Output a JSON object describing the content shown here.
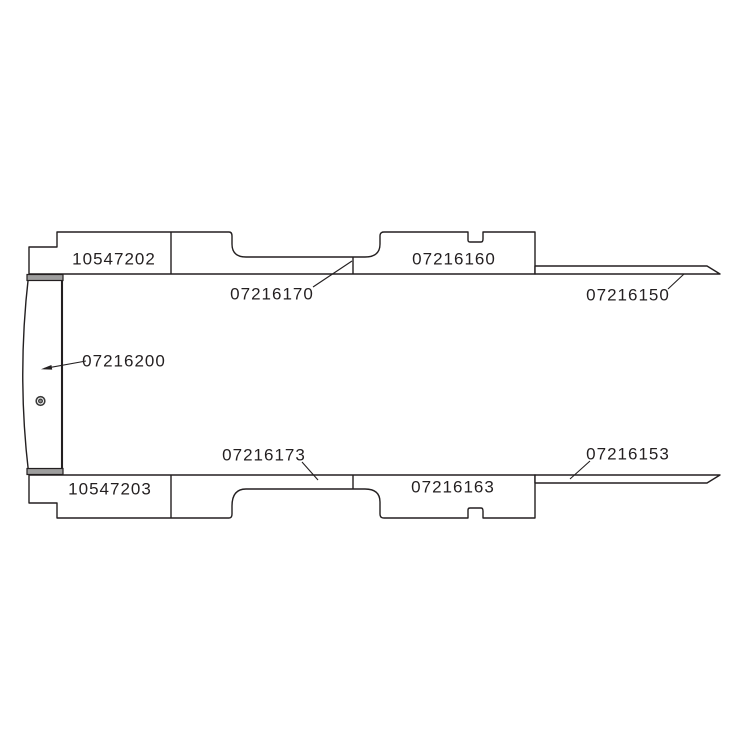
{
  "diagram": {
    "kind": "vehicle panel parts line drawing",
    "colors": {
      "background": "#ffffff",
      "line": "#231f20",
      "seal_band": "#9e9e9e"
    }
  },
  "parts": [
    {
      "number": "10547202",
      "area": "top rail left panel"
    },
    {
      "number": "07216170",
      "area": "top rail recessed sill",
      "leader": true
    },
    {
      "number": "07216160",
      "area": "top rail right panel"
    },
    {
      "number": "07216150",
      "area": "top right thin strip",
      "leader": true
    },
    {
      "number": "07216200",
      "area": "left curved end panel",
      "leader": true,
      "arrow": true
    },
    {
      "number": "07216173",
      "area": "bottom rail recessed sill",
      "leader": true
    },
    {
      "number": "07216163",
      "area": "bottom rail right panel"
    },
    {
      "number": "07216153",
      "area": "bottom right thin strip",
      "leader": true
    },
    {
      "number": "10547203",
      "area": "bottom rail left panel"
    }
  ]
}
